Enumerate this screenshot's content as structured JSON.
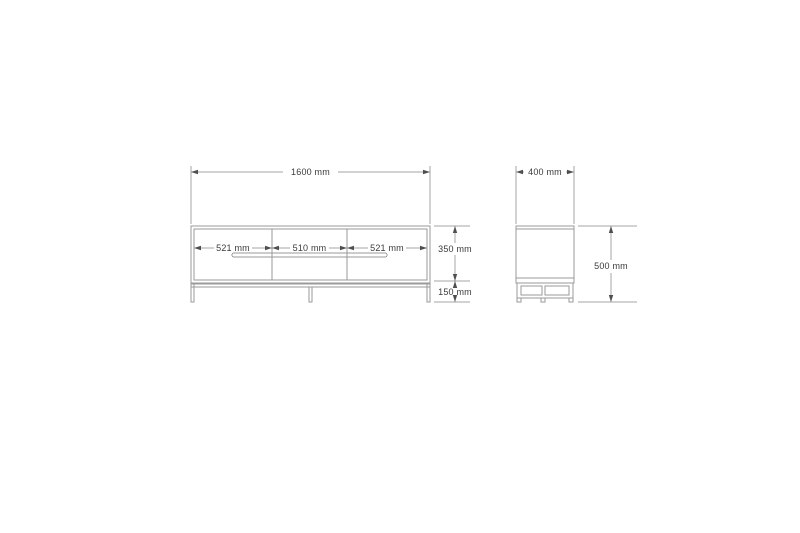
{
  "drawing": {
    "title": "tv-stand-dimension-drawing",
    "colors": {
      "background": "#ffffff",
      "object_line": "#9a9a9a",
      "dimension_line": "#a6a6a6",
      "text": "#3a3a3a"
    },
    "front_view": {
      "overall_width": "1600 mm",
      "sections": {
        "left": "521 mm",
        "middle": "510 mm",
        "right": "521 mm"
      },
      "body_height": "350 mm",
      "leg_height": "150 mm"
    },
    "side_view": {
      "depth": "400 mm",
      "overall_height": "500 mm"
    }
  }
}
